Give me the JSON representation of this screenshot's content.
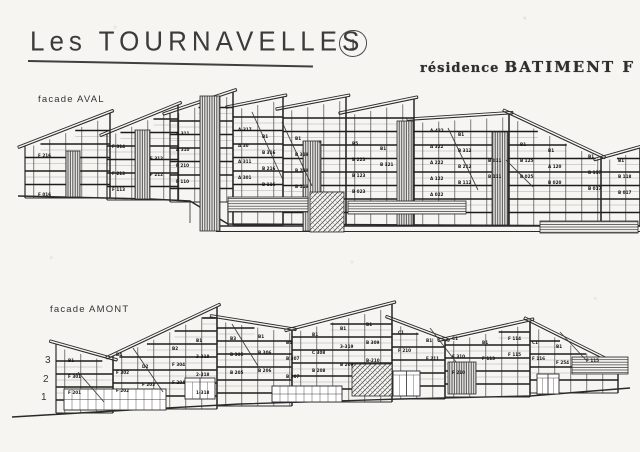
{
  "header": {
    "title": "Les TOURNAVELLES",
    "sheet_number": "1",
    "residence_prefix": "résidence",
    "residence_name": "BATIMENT F"
  },
  "ink_color": "#2a2a2a",
  "paper_color": "#f6f5f1",
  "facades": {
    "aval": {
      "label": "facade AVAL"
    },
    "amont": {
      "label": "facade AMONT",
      "floor_numbers": [
        "3",
        "2",
        "1"
      ]
    }
  },
  "drawings": {
    "aval": {
      "fs": 13.5,
      "ground": [
        [
          18,
          196
        ],
        [
          150,
          199
        ],
        [
          190,
          201
        ],
        [
          228,
          224
        ],
        [
          640,
          226
        ]
      ],
      "extra": [
        [
          210,
          226,
          640,
          226,
          1.4
        ],
        [
          216,
          231.5,
          640,
          231.5,
          1.1
        ],
        [
          228,
          202,
          228,
          226,
          1.2
        ],
        [
          190,
          202,
          190,
          223,
          0.8
        ]
      ],
      "segments": [
        {
          "x0": 25,
          "x1": 110,
          "y0": 146,
          "y1": 113,
          "base": 198
        },
        {
          "x0": 107,
          "x1": 178,
          "y0": 134,
          "y1": 105,
          "base": 200
        },
        {
          "x0": 170,
          "x1": 233,
          "y0": 113,
          "y1": 92,
          "base": 202,
          "dropBase": 225
        },
        {
          "x0": 233,
          "x1": 283,
          "y0": 107,
          "y1": 97,
          "base": 225
        },
        {
          "x0": 283,
          "x1": 346,
          "y0": 109,
          "y1": 97,
          "base": 226
        },
        {
          "x0": 346,
          "x1": 414,
          "y0": 113,
          "y1": 99,
          "base": 226
        },
        {
          "x0": 414,
          "x1": 509,
          "y0": 120,
          "y1": 114,
          "base": 226
        },
        {
          "x0": 509,
          "x1": 601,
          "y0": 114,
          "y1": 157,
          "base": 226
        },
        {
          "x0": 601,
          "x1": 640,
          "y0": 159,
          "y1": 148,
          "base": 226
        }
      ],
      "panels": [
        [
          "vs",
          66,
          151,
          14,
          46
        ],
        [
          "vs",
          135,
          130,
          15,
          69
        ],
        [
          "vs",
          200,
          96,
          20,
          135
        ],
        [
          "vs",
          303,
          141,
          18,
          90
        ],
        [
          "vs",
          397,
          121,
          16,
          104
        ],
        [
          "vs",
          492,
          132,
          16,
          93
        ],
        [
          "xh",
          310,
          192,
          34,
          40
        ],
        [
          "hs",
          228,
          197,
          80,
          15
        ],
        [
          "hs",
          348,
          201,
          118,
          13
        ],
        [
          "hs",
          540,
          221,
          98,
          12
        ]
      ],
      "diagonals": [
        [
          252,
          112,
          283,
          180
        ],
        [
          282,
          122,
          312,
          186
        ],
        [
          448,
          128,
          478,
          190
        ],
        [
          506,
          160,
          533,
          187
        ]
      ],
      "labels": [
        [
          38,
          157,
          "F 216"
        ],
        [
          38,
          196,
          "F 016"
        ],
        [
          112,
          148,
          "F 314"
        ],
        [
          112,
          175,
          "F 213"
        ],
        [
          112,
          191,
          "F 113"
        ],
        [
          150,
          160,
          "F 312"
        ],
        [
          150,
          176,
          "F 212"
        ],
        [
          176,
          135,
          "A 311"
        ],
        [
          176,
          151,
          "A 310"
        ],
        [
          176,
          167,
          "F 210"
        ],
        [
          176,
          183,
          "F 110"
        ],
        [
          238,
          131,
          "A-317"
        ],
        [
          238,
          147,
          "A 30"
        ],
        [
          238,
          163,
          "A 311"
        ],
        [
          238,
          179,
          "A 301"
        ],
        [
          262,
          138,
          "B1"
        ],
        [
          262,
          154,
          "B 316"
        ],
        [
          262,
          170,
          "B 216"
        ],
        [
          262,
          186,
          "B 116"
        ],
        [
          295,
          140,
          "B1"
        ],
        [
          295,
          156,
          "B 319"
        ],
        [
          295,
          172,
          "B 219"
        ],
        [
          295,
          188,
          "B 119"
        ],
        [
          318,
          143,
          "×"
        ],
        [
          352,
          145,
          "B5"
        ],
        [
          352,
          161,
          "B 223"
        ],
        [
          352,
          177,
          "B 123"
        ],
        [
          352,
          193,
          "B 023"
        ],
        [
          380,
          150,
          "B1"
        ],
        [
          380,
          166,
          "B 121"
        ],
        [
          430,
          132,
          "A-422"
        ],
        [
          430,
          148,
          "A 322"
        ],
        [
          430,
          164,
          "A 222"
        ],
        [
          430,
          180,
          "A 122"
        ],
        [
          430,
          196,
          "A 022"
        ],
        [
          458,
          136,
          "B1"
        ],
        [
          458,
          152,
          "B 312"
        ],
        [
          458,
          168,
          "B 212"
        ],
        [
          458,
          184,
          "B 112"
        ],
        [
          488,
          162,
          "B 011"
        ],
        [
          488,
          178,
          "B 111"
        ],
        [
          520,
          146,
          "B1"
        ],
        [
          520,
          162,
          "B 125"
        ],
        [
          520,
          178,
          "B 025"
        ],
        [
          548,
          152,
          "B1"
        ],
        [
          548,
          168,
          "A 120"
        ],
        [
          548,
          184,
          "B 020"
        ],
        [
          588,
          158,
          "B1"
        ],
        [
          588,
          174,
          "B 117"
        ],
        [
          588,
          190,
          "B 017"
        ],
        [
          618,
          162,
          "B1"
        ],
        [
          618,
          178,
          "B 118"
        ],
        [
          618,
          194,
          "B 017"
        ]
      ]
    },
    "amont": {
      "fs": 13,
      "ground": [
        [
          12,
          417
        ],
        [
          113,
          411
        ],
        [
          240,
          404
        ],
        [
          400,
          399
        ],
        [
          530,
          396
        ],
        [
          630,
          388
        ]
      ],
      "extra": [],
      "segments": [
        {
          "x0": 56,
          "x1": 113,
          "y0": 344,
          "y1": 360,
          "base": 413
        },
        {
          "x0": 113,
          "x1": 217,
          "y0": 356,
          "y1": 307,
          "base": 409
        },
        {
          "x0": 217,
          "x1": 292,
          "y0": 318,
          "y1": 330,
          "base": 406
        },
        {
          "x0": 292,
          "x1": 392,
          "y0": 330,
          "y1": 304,
          "base": 402
        },
        {
          "x0": 392,
          "x1": 445,
          "y0": 320,
          "y1": 340,
          "base": 399
        },
        {
          "x0": 445,
          "x1": 530,
          "y0": 340,
          "y1": 321,
          "base": 397
        },
        {
          "x0": 530,
          "x1": 618,
          "y0": 322,
          "y1": 366,
          "base": 393
        }
      ],
      "panels": [
        [
          "grid",
          64,
          389,
          102,
          21
        ],
        [
          "grid",
          272,
          386,
          70,
          16
        ],
        [
          "door",
          185,
          378,
          30,
          21
        ],
        [
          "door",
          393,
          371,
          27,
          25
        ],
        [
          "door",
          537,
          374,
          22,
          20
        ],
        [
          "xh",
          352,
          364,
          40,
          32
        ],
        [
          "vs",
          448,
          362,
          28,
          32
        ],
        [
          "hs",
          572,
          357,
          56,
          17
        ]
      ],
      "diagonals": [
        [
          78,
          372,
          104,
          402
        ],
        [
          133,
          348,
          163,
          392
        ],
        [
          232,
          324,
          258,
          366
        ],
        [
          430,
          328,
          456,
          362
        ],
        [
          560,
          332,
          586,
          360
        ]
      ],
      "labels": [
        [
          68,
          362,
          "B1"
        ],
        [
          68,
          378,
          "F 301"
        ],
        [
          68,
          394,
          "F 201"
        ],
        [
          116,
          356,
          "B4"
        ],
        [
          116,
          374,
          "F 302"
        ],
        [
          116,
          392,
          "F 202"
        ],
        [
          142,
          368,
          "D2"
        ],
        [
          142,
          386,
          "F 203"
        ],
        [
          172,
          350,
          "B2"
        ],
        [
          172,
          366,
          "F 304"
        ],
        [
          172,
          384,
          "F 204"
        ],
        [
          196,
          342,
          "B1"
        ],
        [
          196,
          358,
          "3-318"
        ],
        [
          196,
          376,
          "2-318"
        ],
        [
          196,
          394,
          "1-318"
        ],
        [
          230,
          340,
          "B3"
        ],
        [
          230,
          356,
          "B 305"
        ],
        [
          230,
          374,
          "B 205"
        ],
        [
          258,
          338,
          "B1"
        ],
        [
          258,
          354,
          "B 306"
        ],
        [
          258,
          372,
          "B 206"
        ],
        [
          286,
          344,
          "B4"
        ],
        [
          286,
          360,
          "B 307"
        ],
        [
          286,
          378,
          "B 207"
        ],
        [
          312,
          336,
          "B1"
        ],
        [
          312,
          354,
          "C 308"
        ],
        [
          312,
          372,
          "B 208"
        ],
        [
          340,
          330,
          "B1"
        ],
        [
          340,
          348,
          "3-319"
        ],
        [
          340,
          366,
          "B 209"
        ],
        [
          366,
          326,
          "B1"
        ],
        [
          366,
          344,
          "B 309"
        ],
        [
          366,
          362,
          "B-210"
        ],
        [
          398,
          334,
          "C1"
        ],
        [
          398,
          352,
          "F 210"
        ],
        [
          426,
          342,
          "B1"
        ],
        [
          426,
          360,
          "F 211"
        ],
        [
          452,
          340,
          "C1"
        ],
        [
          452,
          358,
          "F 310"
        ],
        [
          452,
          374,
          "F 210"
        ],
        [
          482,
          344,
          "B1"
        ],
        [
          482,
          360,
          "F 113"
        ],
        [
          508,
          340,
          "F 114"
        ],
        [
          508,
          356,
          "F 115"
        ],
        [
          532,
          344,
          "C1"
        ],
        [
          532,
          360,
          "F 116"
        ],
        [
          556,
          348,
          "B1"
        ],
        [
          556,
          364,
          "F 254"
        ],
        [
          586,
          362,
          "F 115"
        ]
      ]
    }
  },
  "positions": {
    "aval_label": {
      "left": 38,
      "top": 94
    },
    "amont_label": {
      "left": 50,
      "top": 304
    },
    "floor_numbers": [
      [
        45,
        355
      ],
      [
        43,
        374
      ],
      [
        41,
        392
      ]
    ]
  }
}
